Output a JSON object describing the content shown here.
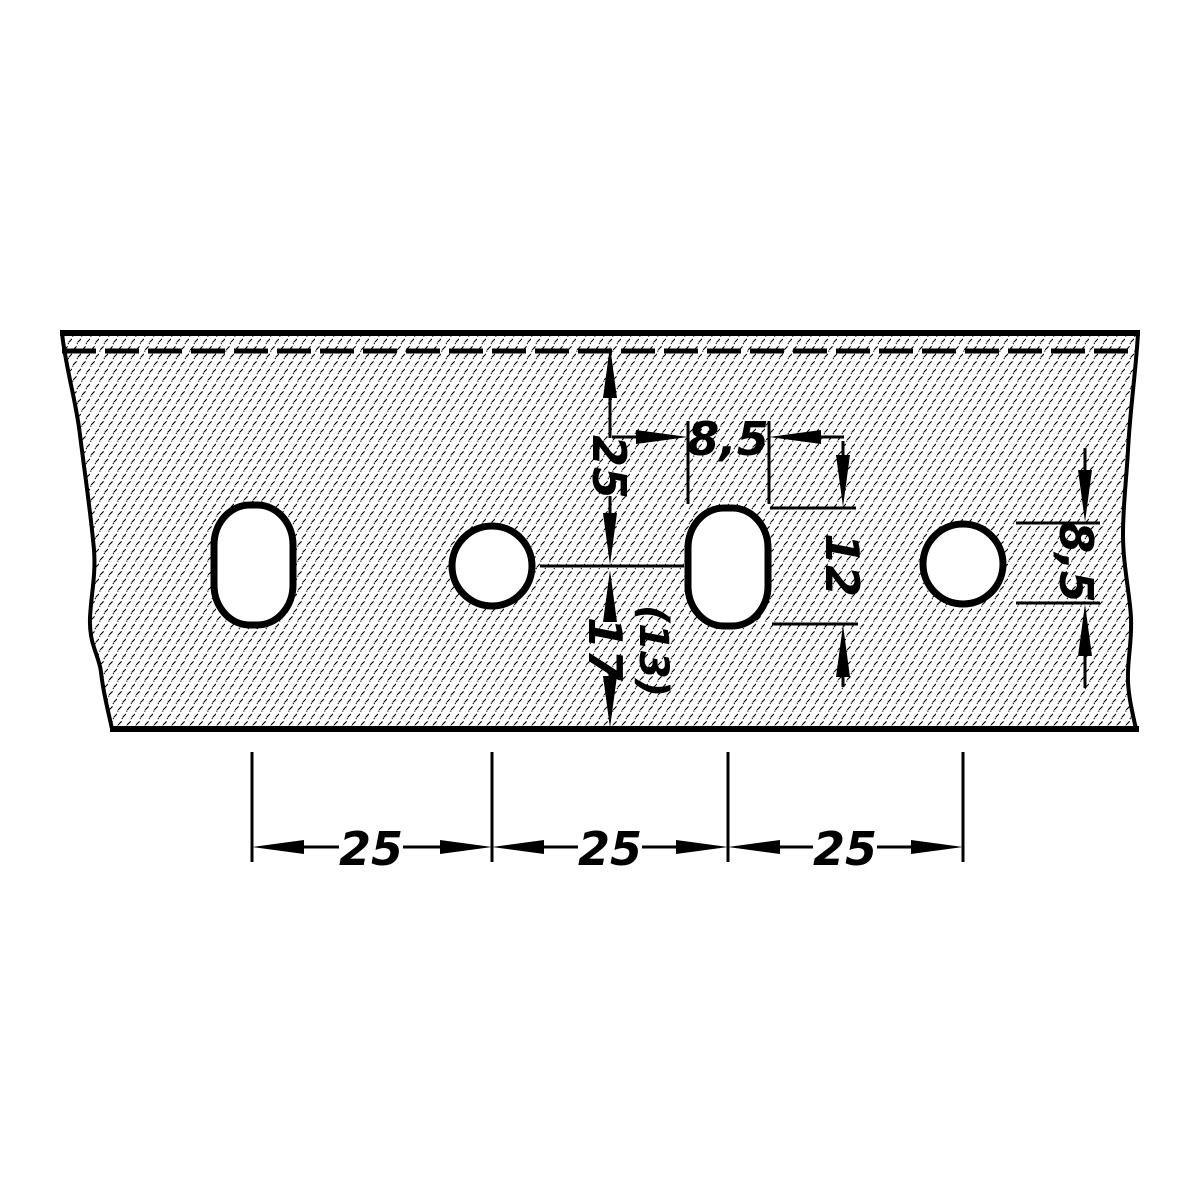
{
  "drawing": {
    "title": "Perforated strip - hole pattern detail",
    "stroke_color": "#000000",
    "background_color": "#ffffff",
    "holes": [
      {
        "type": "slot"
      },
      {
        "type": "round"
      },
      {
        "type": "slot"
      },
      {
        "type": "round"
      }
    ],
    "labels": {
      "dim_top_to_center": "25",
      "slot_width": "8,5",
      "slot_length": "12",
      "center_to_bottom_aux": "(13)",
      "center_to_bottom": "17",
      "hole_diameter": "8,5",
      "pitch_1": "25",
      "pitch_2": "25",
      "pitch_3": "25"
    }
  }
}
